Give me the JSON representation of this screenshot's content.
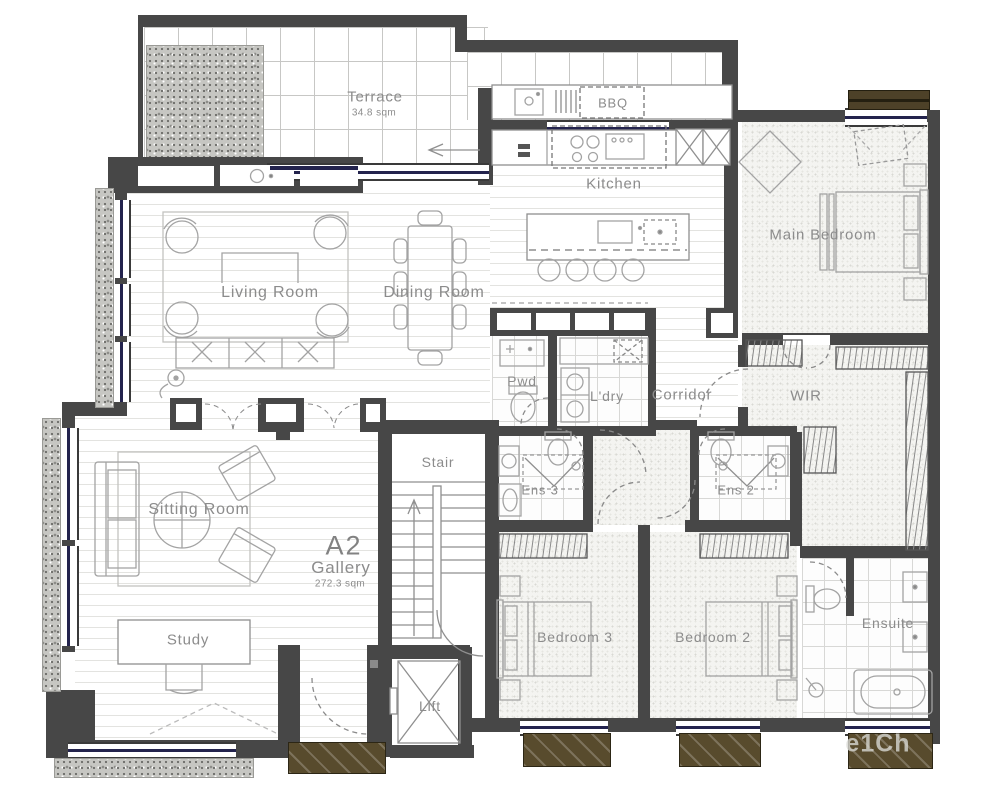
{
  "unit": {
    "id": "A2",
    "name": "Gallery",
    "area": "272.3 sqm"
  },
  "rooms": {
    "terrace": {
      "label": "Terrace",
      "area": "34.8 sqm"
    },
    "bbq": {
      "label": "BBQ"
    },
    "kitchen": {
      "label": "Kitchen"
    },
    "main_bedroom": {
      "label": "Main Bedroom"
    },
    "living": {
      "label": "Living Room"
    },
    "dining": {
      "label": "Dining Room"
    },
    "pwd": {
      "label": "Pwd"
    },
    "ldry": {
      "label": "L'dry"
    },
    "corridor": {
      "label": "Corridor"
    },
    "wir": {
      "label": "WIR"
    },
    "sitting": {
      "label": "Sitting Room"
    },
    "stair": {
      "label": "Stair"
    },
    "ens3": {
      "label": "Ens 3"
    },
    "ens2": {
      "label": "Ens 2"
    },
    "study": {
      "label": "Study"
    },
    "lift": {
      "label": "Lift"
    },
    "bedroom3": {
      "label": "Bedroom 3"
    },
    "bedroom2": {
      "label": "Bedroom 2"
    },
    "ensuite": {
      "label": "Ensuite"
    }
  },
  "watermark": "e1Ch",
  "colors": {
    "wall": "#474747",
    "glazing": "#23234d",
    "awning": "#584b2d",
    "label_text": "#8c8c8c",
    "planter": "#c6c6c2"
  }
}
